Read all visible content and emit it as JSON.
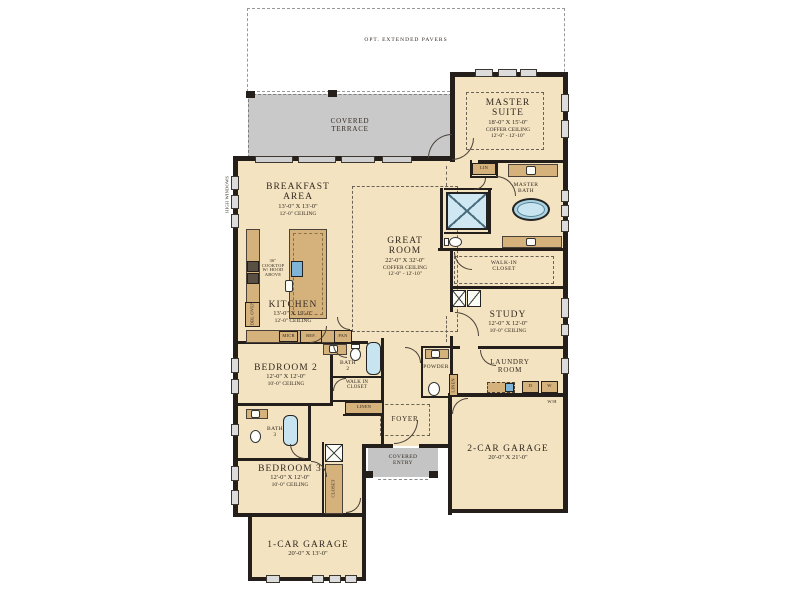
{
  "outdoor": {
    "pavers": "OPT. EXTENDED PAVERS",
    "terrace": {
      "line1": "COVERED",
      "line2": "TERRACE"
    },
    "entry": {
      "line1": "COVERED",
      "line2": "ENTRY"
    }
  },
  "rooms": {
    "master_suite": {
      "name1": "MASTER",
      "name2": "SUITE",
      "dims": "18'-0\" X 15'-0\"",
      "ceil1": "COFFER CEILING",
      "ceil2": "12'-0\" - 12'-10\""
    },
    "breakfast": {
      "name1": "BREAKFAST",
      "name2": "AREA",
      "dims": "13'-0\" X 13'-0\"",
      "ceil": "12'-0\" CEILING"
    },
    "great_room": {
      "name1": "GREAT",
      "name2": "ROOM",
      "dims": "22'-0\" X 32'-0\"",
      "ceil1": "COFFER CEILING",
      "ceil2": "12'-0\" - 12'-10\""
    },
    "kitchen": {
      "name": "KITCHEN",
      "dims": "13'-0\" X 19'-0\"",
      "ceil": "12'-0\" CEILING"
    },
    "master_bath": {
      "name1": "MASTER",
      "name2": "BATH"
    },
    "wic_master": {
      "name1": "WALK-IN",
      "name2": "CLOSET"
    },
    "study": {
      "name": "STUDY",
      "dims": "12'-0\" X 12'-0\"",
      "ceil": "10'-0\" CEILING"
    },
    "laundry": {
      "name1": "LAUNDRY",
      "name2": "ROOM"
    },
    "powder": {
      "name": "POWDER"
    },
    "bath2": {
      "name1": "BATH",
      "name2": "2"
    },
    "wic2": {
      "name1": "WALK IN",
      "name2": "CLOSET"
    },
    "bedroom2": {
      "name": "BEDROOM 2",
      "dims": "12'-0\" X 12'-0\"",
      "ceil": "10'-0\" CEILING"
    },
    "foyer": {
      "name": "FOYER"
    },
    "garage2": {
      "name": "2-CAR GARAGE",
      "dims": "20'-0\" X 21'-0\""
    },
    "bath3": {
      "name1": "BATH",
      "name2": "3"
    },
    "bedroom3": {
      "name": "BEDROOM 3",
      "dims": "12'-0\" X 12'-0\"",
      "ceil": "10'-0\" CEILING"
    },
    "closet3": {
      "name": "CLOSET"
    },
    "garage1": {
      "name": "1-CAR GARAGE",
      "dims": "20'-0\" X 13'-0\""
    }
  },
  "fixtures": {
    "high_windows": "HIGH WINDOWS",
    "cooktop1": "36\"",
    "cooktop2": "COOKTOP",
    "cooktop3": "W/ HOOD",
    "cooktop4": "ABOVE",
    "micr": "MICR",
    "ref": "REF.",
    "pan": "PAN",
    "dbl_oven": "DBL OVEN",
    "lin": "LIN",
    "linen_closet": "LINEN",
    "linen_hall": "LINEN",
    "dryer": "D",
    "washer": "W",
    "water_heater": "W/H"
  },
  "colors": {
    "room_fill": "#f3e3c1",
    "wall": "#241f1b",
    "outdoor_gray": "#c9c9c9",
    "counter": "#d5b17c",
    "fixture_blue": "#c8e4f0"
  }
}
